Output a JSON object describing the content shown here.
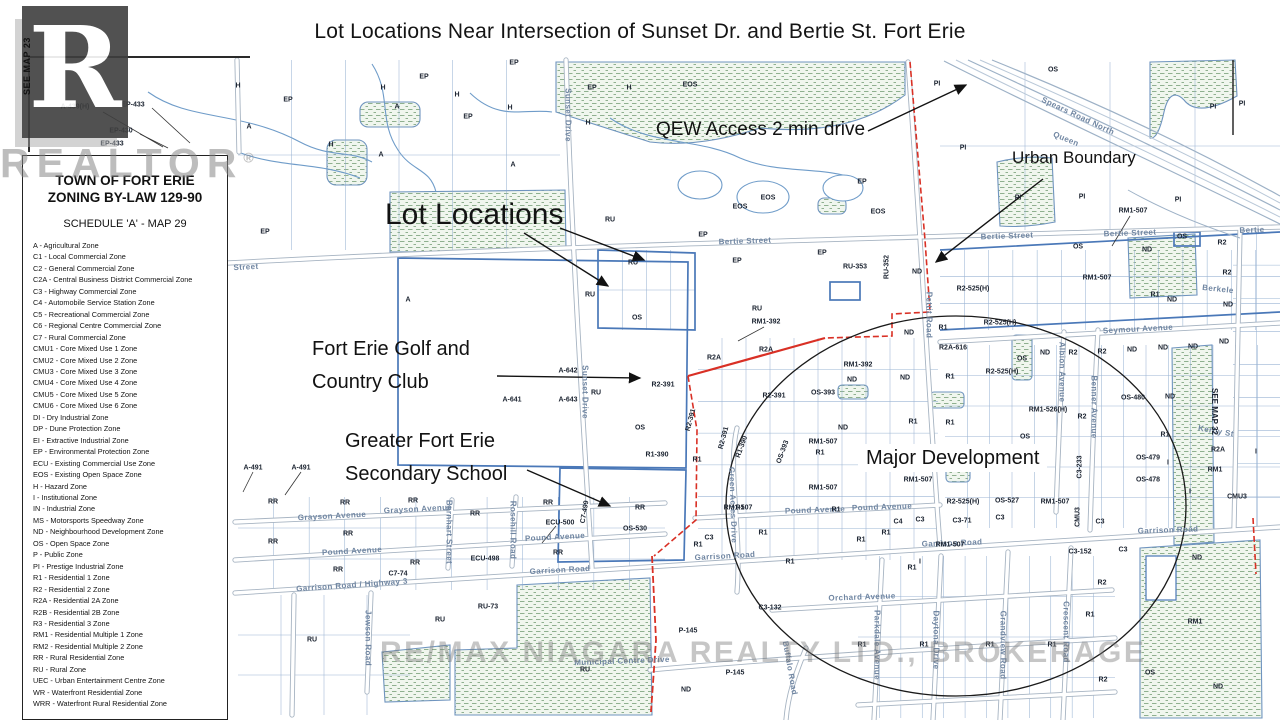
{
  "title": "Lot Locations Near Intersection of Sunset Dr. and Bertie St. Fort Erie",
  "edge_refs": {
    "left": "SEE MAP 23",
    "right": "SEE MAP 32"
  },
  "watermarks": {
    "logo_letter": "R",
    "realtor": "REALTOR",
    "registered": "®",
    "brokerage": "RE/MAX NIAGARA REALTY LTD., BROKERAGE"
  },
  "legend": {
    "title_line1": "TOWN OF FORT ERIE",
    "title_line2": "ZONING BY-LAW 129-90",
    "subtitle": "SCHEDULE 'A' - MAP 29",
    "items": [
      "A - Agricultural Zone",
      "C1 - Local Commercial Zone",
      "C2 - General Commercial Zone",
      "C2A - Central Business District Commercial Zone",
      "C3 - Highway Commercial Zone",
      "C4 - Automobile Service Station Zone",
      "C5 - Recreational Commercial Zone",
      "C6 - Regional Centre Commercial Zone",
      "C7 - Rural Commercial Zone",
      "CMU1 - Core Mixed Use 1 Zone",
      "CMU2 - Core Mixed Use 2 Zone",
      "CMU3 - Core Mixed Use 3 Zone",
      "CMU4 - Core Mixed Use 4 Zone",
      "CMU5 - Core Mixed Use 5 Zone",
      "CMU6 - Core Mixed Use 6 Zone",
      "DI - Dry Industrial Zone",
      "DP - Dune Protection Zone",
      "EI - Extractive Industrial Zone",
      "EP - Environmental Protection Zone",
      "ECU - Existing Commercial Use Zone",
      "EOS - Existing Open Space Zone",
      "H - Hazard Zone",
      "I - Institutional Zone",
      "IN - Industrial Zone",
      "MS - Motorsports Speedway Zone",
      "ND - Neighbourhood Development Zone",
      "OS - Open Space Zone",
      "P - Public Zone",
      "PI - Prestige Industrial Zone",
      "R1 - Residential 1 Zone",
      "R2 - Residential 2 Zone",
      "R2A - Residential 2A Zone",
      "R2B - Residential 2B Zone",
      "R3 - Residential 3 Zone",
      "RM1 - Residential Multiple 1 Zone",
      "RM2 - Residential Multiple 2 Zone",
      "RR - Rural Residential Zone",
      "RU - Rural Zone",
      "UEC - Urban Entertainment Centre Zone",
      "WR - Waterfront Residential Zone",
      "WRR - Waterfront Rural Residential Zone"
    ]
  },
  "annotations": [
    {
      "name": "lot-locations",
      "lines": [
        "Lot Locations"
      ],
      "x": 385,
      "y": 198,
      "fs": 30,
      "lh": 34,
      "bg": false
    },
    {
      "name": "qew-access",
      "lines": [
        "QEW Access 2 min drive"
      ],
      "x": 656,
      "y": 119,
      "fs": 19,
      "lh": 22,
      "bg": false
    },
    {
      "name": "urban-boundary",
      "lines": [
        "Urban Boundary"
      ],
      "x": 1012,
      "y": 148,
      "fs": 17,
      "lh": 20,
      "bg": false
    },
    {
      "name": "golf-club",
      "lines": [
        "Fort Erie Golf and",
        "Country Club"
      ],
      "x": 312,
      "y": 333,
      "fs": 20,
      "lh": 33,
      "bg": false
    },
    {
      "name": "secondary-school",
      "lines": [
        "Greater Fort Erie",
        "Secondary School"
      ],
      "x": 345,
      "y": 425,
      "fs": 20,
      "lh": 33,
      "bg": false
    },
    {
      "name": "major-development",
      "lines": [
        "Major Development"
      ],
      "x": 858,
      "y": 444,
      "fs": 20,
      "lh": 24,
      "bg": true
    }
  ],
  "street_labels": [
    {
      "t": "Bertie Street",
      "x": 745,
      "y": 241,
      "r": -2
    },
    {
      "t": "Bertie Street",
      "x": 1007,
      "y": 236,
      "r": -2
    },
    {
      "t": "Bertie Street",
      "x": 1130,
      "y": 233,
      "r": -2
    },
    {
      "t": "Bertie",
      "x": 1252,
      "y": 230,
      "r": -2
    },
    {
      "t": "Street",
      "x": 246,
      "y": 267,
      "r": -3
    },
    {
      "t": "Grayson Avenue",
      "x": 332,
      "y": 516,
      "r": -3
    },
    {
      "t": "Grayson Avenue",
      "x": 418,
      "y": 509,
      "r": -3
    },
    {
      "t": "Pound Avenue",
      "x": 352,
      "y": 551,
      "r": -3
    },
    {
      "t": "Pound Avenue",
      "x": 555,
      "y": 537,
      "r": -3
    },
    {
      "t": "Pound Avenue",
      "x": 815,
      "y": 510,
      "r": -2
    },
    {
      "t": "Pound Avenue",
      "x": 882,
      "y": 507,
      "r": -2
    },
    {
      "t": "Garrison Road / Highway 3",
      "x": 352,
      "y": 585,
      "r": -4
    },
    {
      "t": "Garrison Road",
      "x": 560,
      "y": 570,
      "r": -3
    },
    {
      "t": "Garrison Road",
      "x": 725,
      "y": 556,
      "r": -3
    },
    {
      "t": "Garrison Road",
      "x": 952,
      "y": 543,
      "r": -2
    },
    {
      "t": "Garrison Road",
      "x": 1168,
      "y": 530,
      "r": -2
    },
    {
      "t": "Orchard Avenue",
      "x": 862,
      "y": 597,
      "r": -2
    },
    {
      "t": "Municipal Centre Drive",
      "x": 622,
      "y": 661,
      "r": -2
    },
    {
      "t": "Seymour Avenue",
      "x": 1138,
      "y": 329,
      "r": -3
    },
    {
      "t": "Sunset Drive",
      "x": 568,
      "y": 115,
      "r": 90
    },
    {
      "t": "Sunset Drive",
      "x": 585,
      "y": 392,
      "r": 90
    },
    {
      "t": "Pettit Road",
      "x": 929,
      "y": 315,
      "r": 90
    },
    {
      "t": "Green Acres Drive",
      "x": 733,
      "y": 505,
      "r": 88
    },
    {
      "t": "Albion Avenue",
      "x": 1062,
      "y": 372,
      "r": 90
    },
    {
      "t": "Benner Avenue",
      "x": 1094,
      "y": 407,
      "r": 90
    },
    {
      "t": "Daytona Drive",
      "x": 936,
      "y": 640,
      "r": 90
    },
    {
      "t": "Grandview Road",
      "x": 1003,
      "y": 645,
      "r": 90
    },
    {
      "t": "Crescent Road",
      "x": 1066,
      "y": 632,
      "r": 90
    },
    {
      "t": "Parkdale Avenue",
      "x": 877,
      "y": 645,
      "r": 90
    },
    {
      "t": "Buffalo Road",
      "x": 790,
      "y": 668,
      "r": 80
    },
    {
      "t": "Jewson Road",
      "x": 368,
      "y": 638,
      "r": 90
    },
    {
      "t": "Barnhart Street",
      "x": 449,
      "y": 532,
      "r": 90
    },
    {
      "t": "Rosehill Road",
      "x": 513,
      "y": 530,
      "r": 90
    },
    {
      "t": "Spears Road North",
      "x": 1078,
      "y": 116,
      "r": 25
    },
    {
      "t": "Queen",
      "x": 1066,
      "y": 139,
      "r": 22
    },
    {
      "t": "Berkele",
      "x": 1218,
      "y": 289,
      "r": 6
    },
    {
      "t": "Kerby St",
      "x": 1216,
      "y": 431,
      "r": 10
    }
  ],
  "zone_labels": [
    {
      "t": "A-439(H)",
      "x": 75,
      "y": 107
    },
    {
      "t": "EP-433",
      "x": 133,
      "y": 105
    },
    {
      "t": "EP-430",
      "x": 121,
      "y": 131
    },
    {
      "t": "EP-433",
      "x": 112,
      "y": 144
    },
    {
      "t": "H",
      "x": 238,
      "y": 86
    },
    {
      "t": "EP",
      "x": 288,
      "y": 100
    },
    {
      "t": "H",
      "x": 383,
      "y": 88
    },
    {
      "t": "A",
      "x": 397,
      "y": 107
    },
    {
      "t": "EP",
      "x": 424,
      "y": 77
    },
    {
      "t": "H",
      "x": 457,
      "y": 95
    },
    {
      "t": "EP",
      "x": 468,
      "y": 117
    },
    {
      "t": "EP",
      "x": 514,
      "y": 63
    },
    {
      "t": "H",
      "x": 510,
      "y": 108
    },
    {
      "t": "EP",
      "x": 592,
      "y": 88
    },
    {
      "t": "H",
      "x": 629,
      "y": 88
    },
    {
      "t": "H",
      "x": 588,
      "y": 123
    },
    {
      "t": "A",
      "x": 249,
      "y": 127
    },
    {
      "t": "H",
      "x": 331,
      "y": 145
    },
    {
      "t": "A",
      "x": 381,
      "y": 155
    },
    {
      "t": "A",
      "x": 513,
      "y": 165
    },
    {
      "t": "EP",
      "x": 265,
      "y": 232
    },
    {
      "t": "A",
      "x": 408,
      "y": 300
    },
    {
      "t": "EOS",
      "x": 690,
      "y": 85
    },
    {
      "t": "EOS",
      "x": 740,
      "y": 207
    },
    {
      "t": "EOS",
      "x": 768,
      "y": 198
    },
    {
      "t": "EP",
      "x": 862,
      "y": 182
    },
    {
      "t": "EOS",
      "x": 878,
      "y": 212
    },
    {
      "t": "OS",
      "x": 1053,
      "y": 70
    },
    {
      "t": "PI",
      "x": 937,
      "y": 84
    },
    {
      "t": "PI",
      "x": 1213,
      "y": 107
    },
    {
      "t": "PI",
      "x": 963,
      "y": 148
    },
    {
      "t": "PI",
      "x": 1018,
      "y": 198
    },
    {
      "t": "PI",
      "x": 1082,
      "y": 197
    },
    {
      "t": "PI",
      "x": 1178,
      "y": 200
    },
    {
      "t": "PI",
      "x": 1242,
      "y": 104
    },
    {
      "t": "EP",
      "x": 703,
      "y": 235
    },
    {
      "t": "EP",
      "x": 737,
      "y": 261
    },
    {
      "t": "EP",
      "x": 822,
      "y": 253
    },
    {
      "t": "RU-353",
      "x": 855,
      "y": 267
    },
    {
      "t": "RU-352",
      "x": 887,
      "y": 267,
      "r": -90
    },
    {
      "t": "ND",
      "x": 917,
      "y": 272
    },
    {
      "t": "ND",
      "x": 909,
      "y": 333
    },
    {
      "t": "RM1-507",
      "x": 1133,
      "y": 211
    },
    {
      "t": "R2",
      "x": 1222,
      "y": 243
    },
    {
      "t": "ND",
      "x": 1147,
      "y": 250
    },
    {
      "t": "OS",
      "x": 1078,
      "y": 247
    },
    {
      "t": "OS",
      "x": 1182,
      "y": 237
    },
    {
      "t": "RM1-507",
      "x": 1097,
      "y": 278
    },
    {
      "t": "R2-525(H)",
      "x": 973,
      "y": 289
    },
    {
      "t": "R2",
      "x": 1227,
      "y": 273
    },
    {
      "t": "RU",
      "x": 610,
      "y": 220
    },
    {
      "t": "RU",
      "x": 633,
      "y": 263
    },
    {
      "t": "RU",
      "x": 590,
      "y": 295
    },
    {
      "t": "RU",
      "x": 757,
      "y": 309
    },
    {
      "t": "OS",
      "x": 637,
      "y": 318
    },
    {
      "t": "OS",
      "x": 640,
      "y": 428
    },
    {
      "t": "RU",
      "x": 596,
      "y": 393
    },
    {
      "t": "A-642",
      "x": 568,
      "y": 371
    },
    {
      "t": "A-641",
      "x": 512,
      "y": 400
    },
    {
      "t": "A-643",
      "x": 568,
      "y": 400
    },
    {
      "t": "A-491",
      "x": 253,
      "y": 468
    },
    {
      "t": "A-491",
      "x": 301,
      "y": 468
    },
    {
      "t": "RM1-392",
      "x": 766,
      "y": 322
    },
    {
      "t": "RM1-392",
      "x": 858,
      "y": 365
    },
    {
      "t": "R2A",
      "x": 714,
      "y": 358
    },
    {
      "t": "R2A",
      "x": 766,
      "y": 350
    },
    {
      "t": "R2A-616",
      "x": 953,
      "y": 348
    },
    {
      "t": "R2-391",
      "x": 663,
      "y": 385
    },
    {
      "t": "R2-391",
      "x": 774,
      "y": 396
    },
    {
      "t": "R2-391",
      "x": 691,
      "y": 420,
      "r": -75
    },
    {
      "t": "R2-391",
      "x": 724,
      "y": 438,
      "r": -75
    },
    {
      "t": "OS-393",
      "x": 823,
      "y": 393
    },
    {
      "t": "OS-393",
      "x": 783,
      "y": 452,
      "r": -70
    },
    {
      "t": "R1-390",
      "x": 657,
      "y": 455
    },
    {
      "t": "R1-390",
      "x": 742,
      "y": 447,
      "r": -70
    },
    {
      "t": "ND",
      "x": 852,
      "y": 380
    },
    {
      "t": "ND",
      "x": 905,
      "y": 378
    },
    {
      "t": "ND",
      "x": 843,
      "y": 428
    },
    {
      "t": "ND",
      "x": 1045,
      "y": 353
    },
    {
      "t": "ND",
      "x": 1132,
      "y": 350
    },
    {
      "t": "ND",
      "x": 1163,
      "y": 348
    },
    {
      "t": "ND",
      "x": 1170,
      "y": 397
    },
    {
      "t": "ND",
      "x": 1172,
      "y": 300
    },
    {
      "t": "ND",
      "x": 1228,
      "y": 305
    },
    {
      "t": "ND",
      "x": 1193,
      "y": 347
    },
    {
      "t": "ND",
      "x": 1224,
      "y": 342
    },
    {
      "t": "R1",
      "x": 943,
      "y": 328
    },
    {
      "t": "R1",
      "x": 950,
      "y": 377
    },
    {
      "t": "R1",
      "x": 913,
      "y": 422
    },
    {
      "t": "R1",
      "x": 950,
      "y": 423
    },
    {
      "t": "R1",
      "x": 820,
      "y": 453
    },
    {
      "t": "R1",
      "x": 697,
      "y": 460
    },
    {
      "t": "R1",
      "x": 740,
      "y": 508
    },
    {
      "t": "R1",
      "x": 763,
      "y": 533
    },
    {
      "t": "R1",
      "x": 836,
      "y": 510
    },
    {
      "t": "R1",
      "x": 861,
      "y": 540
    },
    {
      "t": "R1",
      "x": 886,
      "y": 533
    },
    {
      "t": "R1",
      "x": 698,
      "y": 545
    },
    {
      "t": "R1",
      "x": 790,
      "y": 562
    },
    {
      "t": "R1",
      "x": 912,
      "y": 568
    },
    {
      "t": "R1",
      "x": 1155,
      "y": 295
    },
    {
      "t": "R1",
      "x": 1165,
      "y": 435
    },
    {
      "t": "R1",
      "x": 862,
      "y": 645
    },
    {
      "t": "R1",
      "x": 924,
      "y": 645
    },
    {
      "t": "R1",
      "x": 990,
      "y": 645
    },
    {
      "t": "R1",
      "x": 1052,
      "y": 645
    },
    {
      "t": "R1",
      "x": 1090,
      "y": 615
    },
    {
      "t": "R2-525(H)",
      "x": 1000,
      "y": 323
    },
    {
      "t": "R2-525(H)",
      "x": 1002,
      "y": 372
    },
    {
      "t": "R2-525(H)",
      "x": 963,
      "y": 502
    },
    {
      "t": "OS-527",
      "x": 1007,
      "y": 501
    },
    {
      "t": "RM1-526(H)",
      "x": 1048,
      "y": 410
    },
    {
      "t": "RM1-507",
      "x": 823,
      "y": 442
    },
    {
      "t": "RM1-507",
      "x": 823,
      "y": 488
    },
    {
      "t": "RM1-507",
      "x": 738,
      "y": 508
    },
    {
      "t": "RM1-507",
      "x": 1055,
      "y": 502
    },
    {
      "t": "RM1-507",
      "x": 950,
      "y": 545
    },
    {
      "t": "RM1-507",
      "x": 918,
      "y": 480
    },
    {
      "t": "R2",
      "x": 1073,
      "y": 353
    },
    {
      "t": "R2",
      "x": 1102,
      "y": 352
    },
    {
      "t": "R2",
      "x": 1082,
      "y": 417
    },
    {
      "t": "R2",
      "x": 1102,
      "y": 583
    },
    {
      "t": "R2",
      "x": 1103,
      "y": 680
    },
    {
      "t": "OS",
      "x": 1022,
      "y": 359
    },
    {
      "t": "OS",
      "x": 1025,
      "y": 437
    },
    {
      "t": "OS",
      "x": 1150,
      "y": 673
    },
    {
      "t": "OS-480",
      "x": 1133,
      "y": 398
    },
    {
      "t": "OS-479",
      "x": 1148,
      "y": 458
    },
    {
      "t": "OS-478",
      "x": 1148,
      "y": 480
    },
    {
      "t": "OS-530",
      "x": 635,
      "y": 529
    },
    {
      "t": "I",
      "x": 1168,
      "y": 463
    },
    {
      "t": "I",
      "x": 1190,
      "y": 492
    },
    {
      "t": "I",
      "x": 920,
      "y": 562
    },
    {
      "t": "I",
      "x": 1256,
      "y": 452
    },
    {
      "t": "C3-233",
      "x": 1080,
      "y": 467,
      "r": -90
    },
    {
      "t": "CMU3",
      "x": 1078,
      "y": 517,
      "r": -90
    },
    {
      "t": "CMU3",
      "x": 1237,
      "y": 497
    },
    {
      "t": "C3",
      "x": 1100,
      "y": 522
    },
    {
      "t": "C4",
      "x": 898,
      "y": 522
    },
    {
      "t": "C3",
      "x": 920,
      "y": 520
    },
    {
      "t": "C3-71",
      "x": 962,
      "y": 521
    },
    {
      "t": "C3",
      "x": 1000,
      "y": 518
    },
    {
      "t": "C3-152",
      "x": 1080,
      "y": 552
    },
    {
      "t": "C3",
      "x": 1123,
      "y": 550
    },
    {
      "t": "C3",
      "x": 709,
      "y": 538
    },
    {
      "t": "C3-132",
      "x": 770,
      "y": 608
    },
    {
      "t": "C7-74",
      "x": 398,
      "y": 574
    },
    {
      "t": "C7-499",
      "x": 585,
      "y": 512,
      "r": -80
    },
    {
      "t": "ECU-500",
      "x": 560,
      "y": 523
    },
    {
      "t": "ECU-498",
      "x": 485,
      "y": 559
    },
    {
      "t": "RR",
      "x": 273,
      "y": 502
    },
    {
      "t": "RR",
      "x": 345,
      "y": 503
    },
    {
      "t": "RR",
      "x": 413,
      "y": 501
    },
    {
      "t": "RR",
      "x": 475,
      "y": 514
    },
    {
      "t": "RR",
      "x": 348,
      "y": 534
    },
    {
      "t": "RR",
      "x": 273,
      "y": 542
    },
    {
      "t": "RR",
      "x": 338,
      "y": 570
    },
    {
      "t": "RR",
      "x": 415,
      "y": 563
    },
    {
      "t": "RR",
      "x": 558,
      "y": 553
    },
    {
      "t": "RR",
      "x": 548,
      "y": 503
    },
    {
      "t": "RR",
      "x": 640,
      "y": 508
    },
    {
      "t": "RU",
      "x": 312,
      "y": 640
    },
    {
      "t": "RU",
      "x": 440,
      "y": 620
    },
    {
      "t": "RU",
      "x": 585,
      "y": 670
    },
    {
      "t": "RU-73",
      "x": 488,
      "y": 607
    },
    {
      "t": "P-145",
      "x": 688,
      "y": 631
    },
    {
      "t": "P-145",
      "x": 735,
      "y": 673
    },
    {
      "t": "ND",
      "x": 686,
      "y": 690
    },
    {
      "t": "ND",
      "x": 1197,
      "y": 558
    },
    {
      "t": "ND",
      "x": 1218,
      "y": 687
    },
    {
      "t": "RM1",
      "x": 1195,
      "y": 622
    },
    {
      "t": "RM1",
      "x": 1215,
      "y": 470
    },
    {
      "t": "R2A",
      "x": 1218,
      "y": 450
    }
  ],
  "colors": {
    "parcel_blue": "#4a78b8",
    "grid_blue": "#89a7cc",
    "hatch_green": "#8fb08f",
    "road_casing": "#a7b4c2",
    "boundary_red": "#d93025",
    "street_text": "#7086a2",
    "zone_text": "#1b2330",
    "annotation_black": "#121212"
  }
}
